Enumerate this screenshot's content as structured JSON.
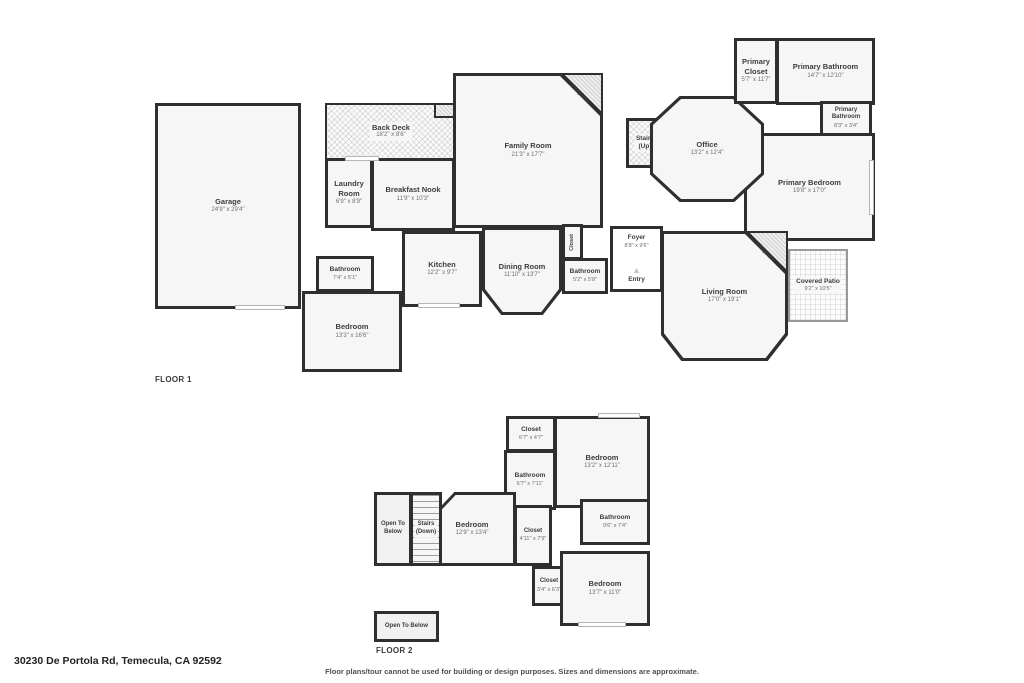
{
  "page": {
    "address": "30230 De Portola Rd, Temecula, CA 92592",
    "disclaimer": "Floor plans/tour cannot be used for building or design purposes. Sizes and dimensions are approximate.",
    "wall_color": "#2f2f2f",
    "room_fill": "#f6f6f6"
  },
  "floor1": {
    "label": "FLOOR 1",
    "rooms": {
      "garage": {
        "name": "Garage",
        "dims": "24'9\" x 29'4\""
      },
      "back_deck": {
        "name": "Back Deck",
        "dims": "18'2\" x 8'6\""
      },
      "laundry_room": {
        "name": "Laundry Room",
        "dims": "6'9\" x 8'9\""
      },
      "breakfast_nook": {
        "name": "Breakfast Nook",
        "dims": "11'9\" x 10'3\""
      },
      "family_room": {
        "name": "Family Room",
        "dims": "21'3\" x 17'7\""
      },
      "fireplace_family": {
        "name": "Fireplace"
      },
      "stairs_up": {
        "name": "Stairs",
        "sub": "(Up)"
      },
      "office": {
        "name": "Office",
        "dims": "13'2\" x 12'4\""
      },
      "primary_closet": {
        "name": "Primary Closet",
        "dims": "5'7\" x 11'7\""
      },
      "primary_bathroom": {
        "name": "Primary Bathroom",
        "dims": "14'7\" x 12'10\""
      },
      "primary_bathroom_2": {
        "name": "Primary Bathroom",
        "dims": "8'3\" x 3'4\""
      },
      "primary_bedroom": {
        "name": "Primary Bedroom",
        "dims": "19'8\" x 17'0\""
      },
      "bathroom_hall": {
        "name": "Bathroom",
        "dims": "7'4\" x 5'1\""
      },
      "bedroom_front": {
        "name": "Bedroom",
        "dims": "13'3\" x 16'6\""
      },
      "kitchen": {
        "name": "Kitchen",
        "dims": "12'2\" x 9'7\""
      },
      "dining_room": {
        "name": "Dining Room",
        "dims": "11'10\" x 13'7\""
      },
      "closet_hall": {
        "name": "Closet"
      },
      "bathroom_center": {
        "name": "Bathroom",
        "dims": "5'2\" x 5'8\""
      },
      "foyer": {
        "name": "Foyer",
        "dims": "8'8\" x 9'6\""
      },
      "entry": {
        "name": "Entry",
        "marker": "▲"
      },
      "living_room": {
        "name": "Living Room",
        "dims": "17'0\" x 19'1\""
      },
      "fireplace_living": {
        "name": "Fireplace"
      },
      "covered_patio": {
        "name": "Covered Patio",
        "dims": "9'2\" x 10'5\""
      }
    }
  },
  "floor2": {
    "label": "FLOOR 2",
    "rooms": {
      "closet_top": {
        "name": "Closet",
        "dims": "6'7\" x 4'7\""
      },
      "bedroom_ne": {
        "name": "Bedroom",
        "dims": "13'2\" x 12'11\""
      },
      "bathroom_mid": {
        "name": "Bathroom",
        "dims": "6'7\" x 7'11\""
      },
      "bedroom_w": {
        "name": "Bedroom",
        "dims": "12'9\" x 13'4\""
      },
      "closet_mid": {
        "name": "Closet",
        "dims": "4'11\" x 7'9\""
      },
      "bathroom_e": {
        "name": "Bathroom",
        "dims": "9'6\" x 7'4\""
      },
      "open_below_left": {
        "name": "Open To Below"
      },
      "stairs_down": {
        "name": "Stairs",
        "sub": "(Down)"
      },
      "closet_bottom": {
        "name": "Closet",
        "dims": "3'4\" x 6'3\""
      },
      "bedroom_s": {
        "name": "Bedroom",
        "dims": "13'7\" x 11'0\""
      },
      "open_below_bottom": {
        "name": "Open To Below"
      }
    }
  }
}
